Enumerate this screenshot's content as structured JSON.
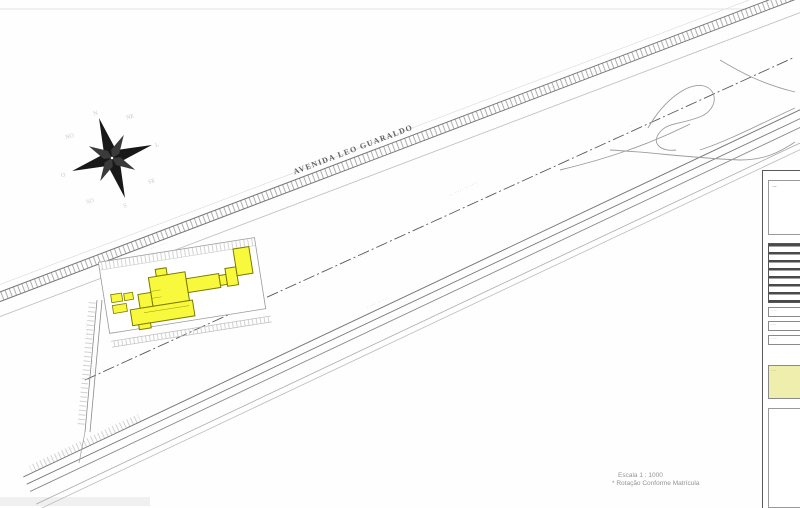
{
  "page": {
    "background": "#fefefe"
  },
  "colors": {
    "building_fill": "#f8f83c",
    "building_stroke": "#7a7a00",
    "parcel_line": "#999999",
    "road_dark": "#777777",
    "road_light": "#bbbbbb",
    "titleblock_yellow": "#f0eead"
  },
  "compass": {
    "points": [
      "N",
      "NE",
      "L",
      "SE",
      "S",
      "SO",
      "O",
      "NO"
    ]
  },
  "map": {
    "avenue_label": "AVENIDA LEO GUARALDO",
    "rail_label": "·· ····· ·· ····",
    "dim_labels": [
      "···· ····",
      "··· ·····",
      "···· ···",
      "··· ····"
    ],
    "mid_dim_label": "···· ····",
    "duct_label": "· ··· ·· ···",
    "street_labels": [
      "··· ·····",
      "·· ····"
    ],
    "left_edge_label": "··· ·····",
    "bottom_left_label": "··· ········ ··",
    "ramp_labels": [
      "·· ···",
      "··· ··"
    ]
  },
  "titleblock": {
    "box1_mark": "·–",
    "field_rows": [
      "·····",
      "····",
      "·····"
    ],
    "yellow_note": "····"
  },
  "footer": {
    "scale_text": "Escala  1 : 1000",
    "note_text": "* Rotação Conforme Matrícula"
  }
}
